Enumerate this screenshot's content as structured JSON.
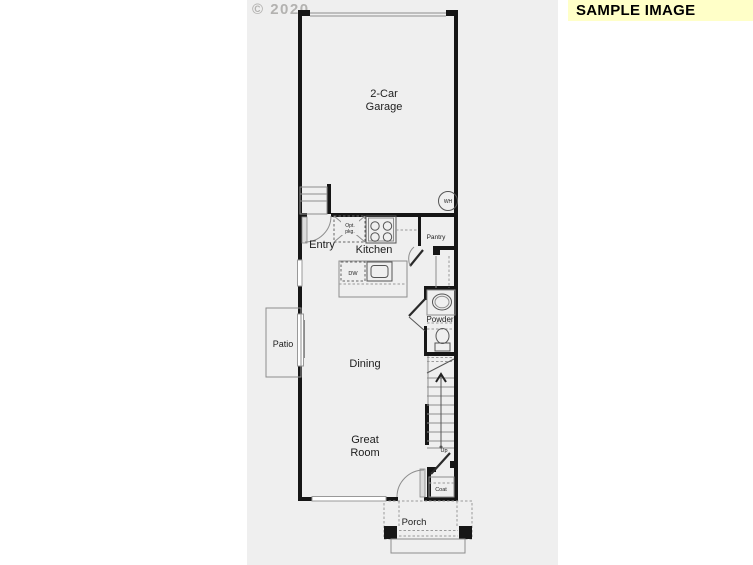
{
  "watermark": "© 2020",
  "banner": {
    "label": "SAMPLE IMAGE"
  },
  "rooms": {
    "garage_line1": "2-Car",
    "garage_line2": "Garage",
    "entry": "Entry",
    "kitchen": "Kitchen",
    "pantry": "Pantry",
    "powder": "Powder",
    "patio": "Patio",
    "dining": "Dining",
    "great_line1": "Great",
    "great_line2": "Room",
    "porch": "Porch",
    "coat": "Coat"
  },
  "fixtures": {
    "water_heater": "WH",
    "dishwasher": "DW",
    "stairs_direction": "Up",
    "opt_line1": "Opt.",
    "opt_line2": "pkg."
  },
  "colors": {
    "banner_bg": "#ffffc8",
    "wall": "#161616",
    "scan_bg": "#efefef",
    "watermark_color": "#b3b2b0"
  }
}
